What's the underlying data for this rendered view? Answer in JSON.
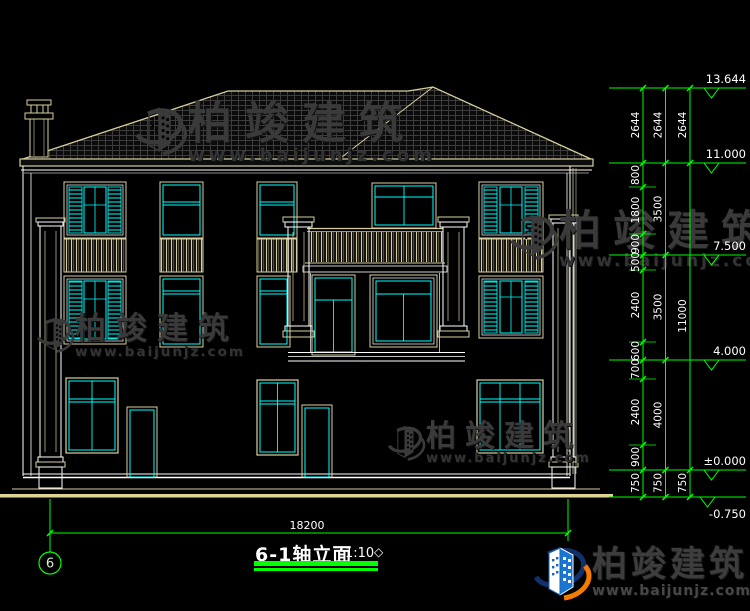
{
  "drawing": {
    "title": "6-1轴立面",
    "scale_label": "1:10",
    "axis_number": "6",
    "overall_width_dim": "18200"
  },
  "levels": [
    "13.644",
    "11.000",
    "7.500",
    "4.000",
    "±0.000",
    "-0.750"
  ],
  "dims": {
    "chain1": [
      "2644",
      "800",
      "1800",
      "900",
      "500",
      "2400",
      "600",
      "700",
      "2400",
      "900",
      "750"
    ],
    "chain2": [
      "2644",
      "3500",
      "3500",
      "4000",
      "750"
    ],
    "chain3": [
      "2644",
      "11000",
      "750"
    ]
  },
  "watermark": {
    "brand": "柏竣建筑",
    "url": "www.baijunjz.com"
  },
  "logo": {
    "brand": "柏竣建筑",
    "url": "www.baijunjz.com"
  },
  "colors": {
    "background": "#000000",
    "wall_outline": "#ffffff",
    "window": "#00ffff",
    "frame_trim": "#d8cfa0",
    "dimension": "#00ff00",
    "watermark": "#3a3a3a",
    "logo_blue": "#1976d2",
    "logo_orange": "#f57c00"
  }
}
